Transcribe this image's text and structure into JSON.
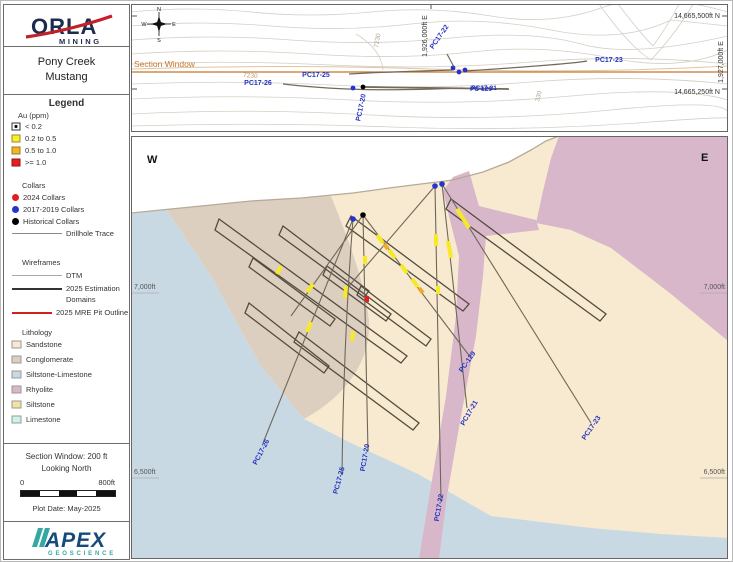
{
  "title_block": {
    "company": "ORLA",
    "company_sub": "MINING",
    "project_line1": "Pony Creek",
    "project_line2": "Mustang"
  },
  "legend": {
    "heading": "Legend",
    "au_heading": "Au (ppm)",
    "au_classes": [
      {
        "label": "< 0.2",
        "color": "#ffffff"
      },
      {
        "label": "0.2 to 0.5",
        "color": "#f8ee2e"
      },
      {
        "label": "0.5 to 1.0",
        "color": "#f3b32a"
      },
      {
        "label": ">= 1.0",
        "color": "#e81e1e"
      }
    ],
    "collars_heading": "Collars",
    "collar_items": [
      {
        "label": "2024 Collars",
        "color": "#e02020"
      },
      {
        "label": "2017-2019 Collars",
        "color": "#2535cc"
      },
      {
        "label": "Historical Collars",
        "color": "#000000"
      }
    ],
    "trace_label": "Drillhole Trace",
    "wireframes_heading": "Wireframes",
    "dtm_label": "DTM",
    "estimation_line1": "2025 Estimation",
    "estimation_line2": "Domains",
    "pit_label": "2025 MRE Pit Outline",
    "lithology_heading": "Lithology",
    "lithology_items": [
      {
        "label": "Sandstone",
        "color": "#f6e9cf"
      },
      {
        "label": "Conglomerate",
        "color": "#ddcfc0"
      },
      {
        "label": "Siltstone-Limestone",
        "color": "#c6d7e2"
      },
      {
        "label": "Rhyolite",
        "color": "#dcbccb"
      },
      {
        "label": "Siltstone",
        "color": "#f3e2a2"
      },
      {
        "label": "Limestone",
        "color": "#ccf2ee"
      }
    ]
  },
  "info_block": {
    "window": "Section Window: 200 ft",
    "looking": "Looking North",
    "scale_min": "0",
    "scale_max": "800ft",
    "plot_date": "Plot Date: May-2025"
  },
  "apex_logo": {
    "name": "APEX",
    "sub": "GEOSCIENCE"
  },
  "plan_view": {
    "section_window_label": "Section Window",
    "compass": {
      "n": "N",
      "e": "E",
      "s": "S",
      "w": "W"
    },
    "coords": {
      "ne_top": "14,665,500ft N",
      "ne_bottom": "14,665,250ft N",
      "e_right": "1,927,000ft E",
      "e_mid": "1,926,000ft E"
    },
    "contours": {
      "c1": "7230",
      "c2": "7230",
      "c3": "330"
    },
    "labels": {
      "pc26": "PC17-26",
      "pc25": "PC17-25",
      "pc20": "PC17-20",
      "pc22": "PC17-22",
      "pc129": "PC-129",
      "pc21": "PC17-21",
      "pc23": "PC17-23"
    }
  },
  "section_view": {
    "west": "W",
    "east": "E",
    "elev_7000": "7,000ft",
    "elev_6500": "6,500ft",
    "labels": {
      "pc26": "PC17-26",
      "pc25": "PC17-25",
      "pc20": "PC17-20",
      "pc22": "PC17-22",
      "pc21": "PC17-21",
      "pc129": "PC-129",
      "pc23": "PC17-23"
    }
  },
  "colors": {
    "hole_label": "#2433c0",
    "section_window": "#c8762a",
    "au_02_05": "#f8ee2e",
    "au_05_10": "#f3b32a",
    "au_10": "#e81e1e",
    "collar_2024": "#e02020",
    "collar_2017": "#2535cc",
    "collar_hist": "#000000",
    "sandstone": "#f8ead0",
    "conglomerate": "#ddcfc0",
    "siltstone_limestone": "#c9d9e3",
    "rhyolite": "#d9b7ca",
    "siltstone": "#f3e2a2",
    "limestone": "#ccf2ee",
    "pit_outline": "#d02020",
    "orla_navy": "#1d2b4c",
    "orla_red": "#c3202a",
    "apex_blue": "#164a7b",
    "apex_teal": "#35a8a2"
  }
}
